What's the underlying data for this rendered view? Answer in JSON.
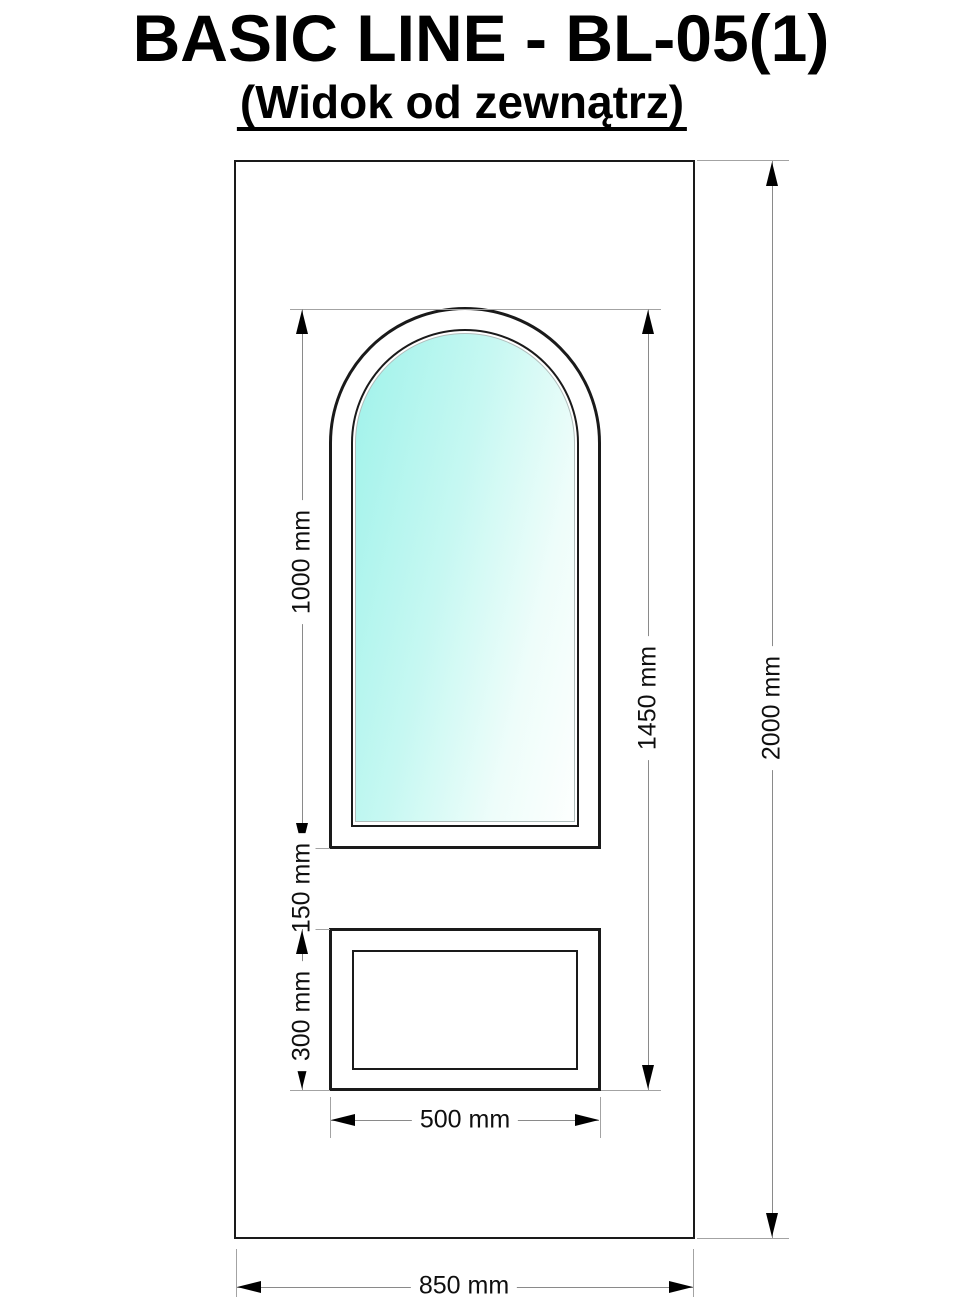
{
  "title": "BASIC LINE - BL-05(1)",
  "subtitle": "(Widok od zewnątrz)",
  "dimensions": {
    "glass_height": "1000 mm",
    "gap_height": "150 mm",
    "panel_height": "300 mm",
    "window_total_height": "1450 mm",
    "door_height": "2000 mm",
    "panel_width": "500 mm",
    "door_width": "850 mm"
  },
  "colors": {
    "outline": "#1a1a1a",
    "dim_line": "#8a8a8a",
    "ext_line": "#a3a3a3",
    "arrow": "#000000",
    "label": "#0f0f0f",
    "background": "#ffffff",
    "glass_start": "#9ff2ea",
    "glass_mid": "#c6f8f2",
    "glass_end": "#fdfffe"
  }
}
